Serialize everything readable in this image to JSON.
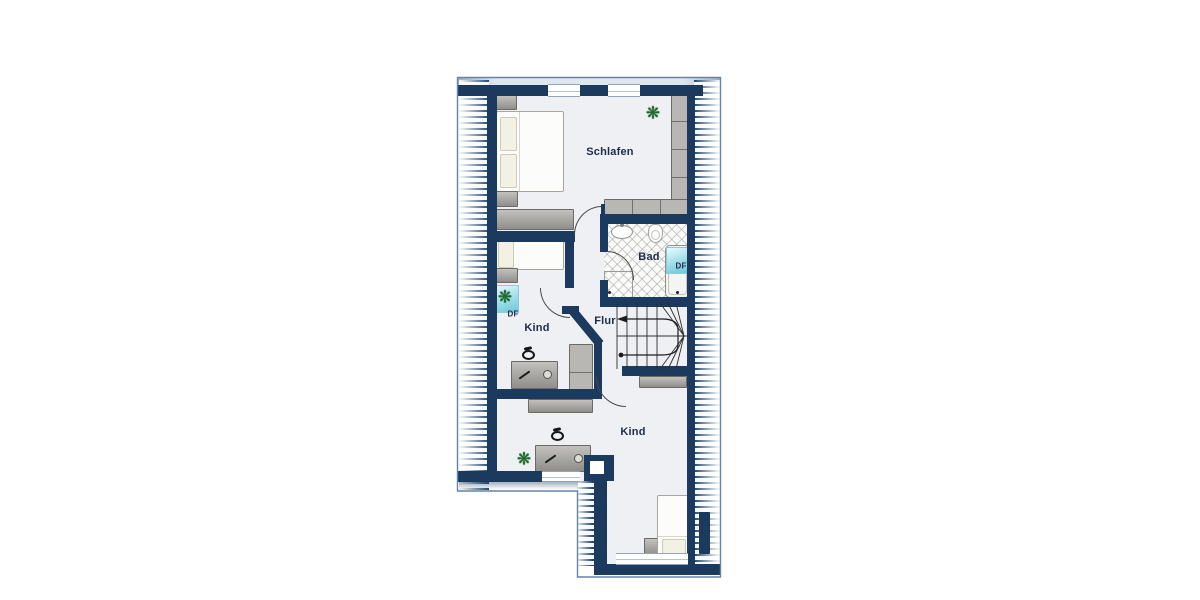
{
  "floorplan": {
    "kind": "attic floor plan",
    "rooms": {
      "schlafen": "Schlafen",
      "bad": "Bad",
      "flur": "Flur",
      "kind_mid": "Kind",
      "kind_bottom": "Kind"
    },
    "roof_windows": {
      "kind": "DF",
      "bad": "DF"
    },
    "colors": {
      "wall": "#1b3a5d",
      "floor": "#eef0f4",
      "roof_window_glass": "#8fd8e6",
      "furniture_grey": "#a5a4a0",
      "bathroom_tile": "#fafaf8",
      "plant_green": "#1e6b2b",
      "outline": "#6684a6",
      "label_text": "#1c2b4a"
    }
  }
}
